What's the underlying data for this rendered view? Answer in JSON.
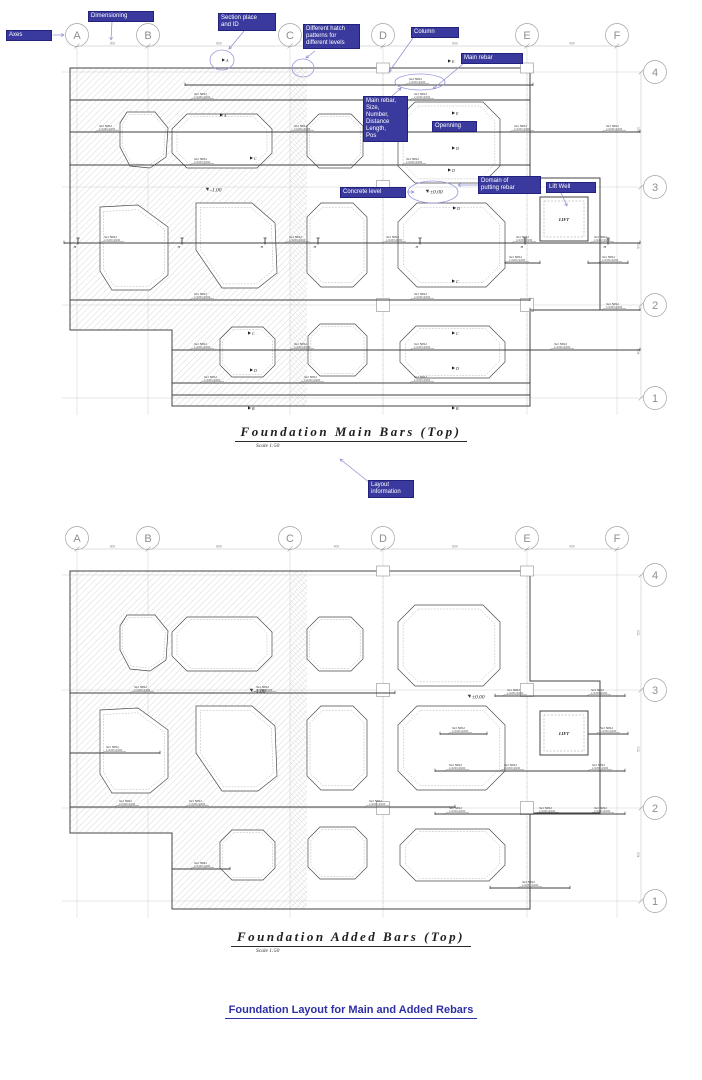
{
  "sheet": {
    "background": "#ffffff"
  },
  "colors": {
    "annotation_fill": "#3a3a9e",
    "annotation_border": "#22227c",
    "annotation_text": "#ffffff",
    "leader_arrow": "#8c8cd0",
    "highlight_ellipse": "#9a9ade",
    "drawing_line": "#3f3f3f",
    "grid_line": "#cfcfcf",
    "hatch_line": "#b9b9b9",
    "footer_text": "#2f2fa8",
    "title_text": "#1f1f1f"
  },
  "axes": {
    "columns": [
      "A",
      "B",
      "C",
      "D",
      "E",
      "F"
    ],
    "column_dims": [
      "300",
      "600",
      "400",
      "600",
      "400"
    ],
    "rows": [
      "4",
      "3",
      "2",
      "1"
    ],
    "row_dims": [
      "500",
      "500",
      "400"
    ]
  },
  "drawings": [
    {
      "title": "Foundation Main Bars (Top)",
      "scale": "Scale 1:50",
      "level_zero": "±0.00",
      "level_minus": "-1.00",
      "lift_label": "LIFT"
    },
    {
      "title": "Foundation Added Bars (Top)",
      "scale": "Scale 1:50",
      "level_zero": "±0.00",
      "level_minus": "-1.00",
      "lift_label": "LIFT"
    }
  ],
  "annotations": {
    "dimensioning": {
      "lines": [
        "Dimensioning"
      ]
    },
    "axes_label": {
      "lines": [
        "Axes"
      ]
    },
    "section_place": {
      "lines": [
        "Section place",
        "and ID"
      ]
    },
    "hatch_patterns": {
      "lines": [
        "Different hatch",
        "patterns for",
        "different levels"
      ]
    },
    "column": {
      "lines": [
        "Column"
      ]
    },
    "main_rebar": {
      "lines": [
        "Main rebar"
      ]
    },
    "main_rebar_info": {
      "lines": [
        "Main rebar,",
        "Size,",
        "Number,",
        "Distance",
        "Length,",
        "Pos"
      ]
    },
    "openning": {
      "lines": [
        "Openning"
      ]
    },
    "concrete_level": {
      "lines": [
        "Concrete level"
      ]
    },
    "domain": {
      "lines": [
        "Domain of",
        "putting rebar"
      ]
    },
    "lift_well": {
      "lines": [
        "Lift Well"
      ]
    },
    "layout_info": {
      "lines": [
        "Layout",
        "information"
      ]
    }
  },
  "rebar_callout": {
    "line1": "№1 5Ø12",
    "line2": "L=1150 @200"
  },
  "section_letters": [
    "A",
    "B",
    "C",
    "D",
    "E",
    "H"
  ],
  "footer": {
    "title": "Foundation Layout for Main and Added Rebars"
  }
}
